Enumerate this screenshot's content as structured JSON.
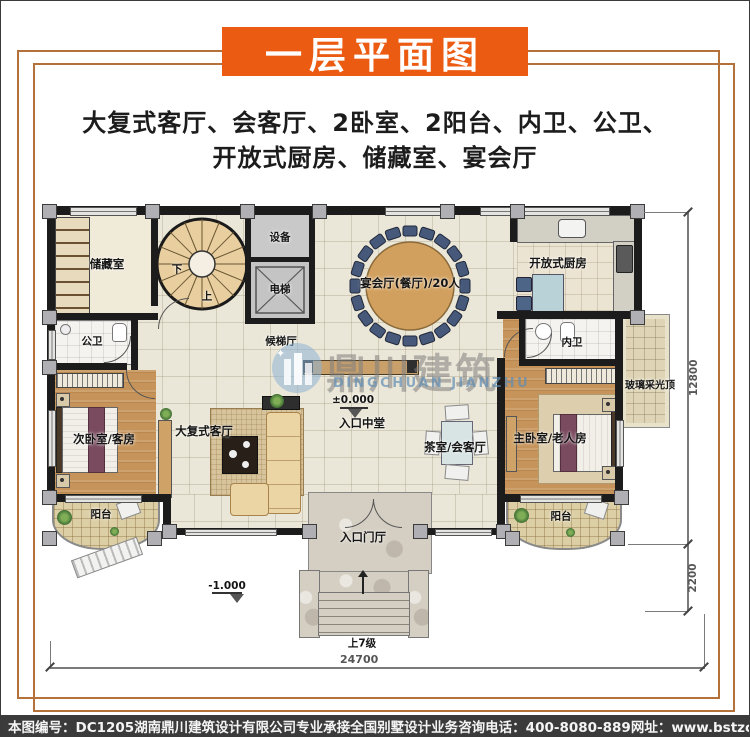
{
  "title": "一层平面图",
  "description": {
    "line1": "大复式客厅、会客厅、2卧室、2阳台、内卫、公卫、",
    "line2": "开放式厨房、储藏室、宴会厅"
  },
  "rooms": {
    "storage": "储藏室",
    "equipment": "设备",
    "elevator": "电梯",
    "public_wc": "公卫",
    "elevator_hall": "候梯厅",
    "banquet": "宴会厅(餐厅)/20人",
    "kitchen": "开放式厨房",
    "inner_wc": "内卫",
    "skylight": "玻璃采光顶",
    "second_bedroom": "次卧室/客房",
    "living": "大复式客厅",
    "entry_center": "入口中堂",
    "tea_room": "茶室/会客厅",
    "master_bedroom": "主卧室/老人房",
    "balcony_left": "阳台",
    "balcony_right": "阳台",
    "entry_foyer": "入口门厅"
  },
  "stairs": {
    "up": "上",
    "down": "下",
    "steps_note": "上7级"
  },
  "levels": {
    "zero": "±0.000",
    "minus": "-1.000"
  },
  "dimensions": {
    "bottom": "24700",
    "right_main": "12800",
    "right_lower": "2200"
  },
  "watermark": {
    "cn": "鼎川建筑",
    "en": "DINGCHUAN JIANZHU"
  },
  "footer": {
    "plan_no": "本图编号：DC1205",
    "company": "湖南鼎川建筑设计有限公司专业承接全国别墅设计业务",
    "phone": "咨询电话：400-8080-889",
    "website": "网址：www.bstzcs.com"
  },
  "colors": {
    "banner": "#ec5b12",
    "frame": "#b5713a",
    "footer_bg": "#3b3b3b"
  }
}
